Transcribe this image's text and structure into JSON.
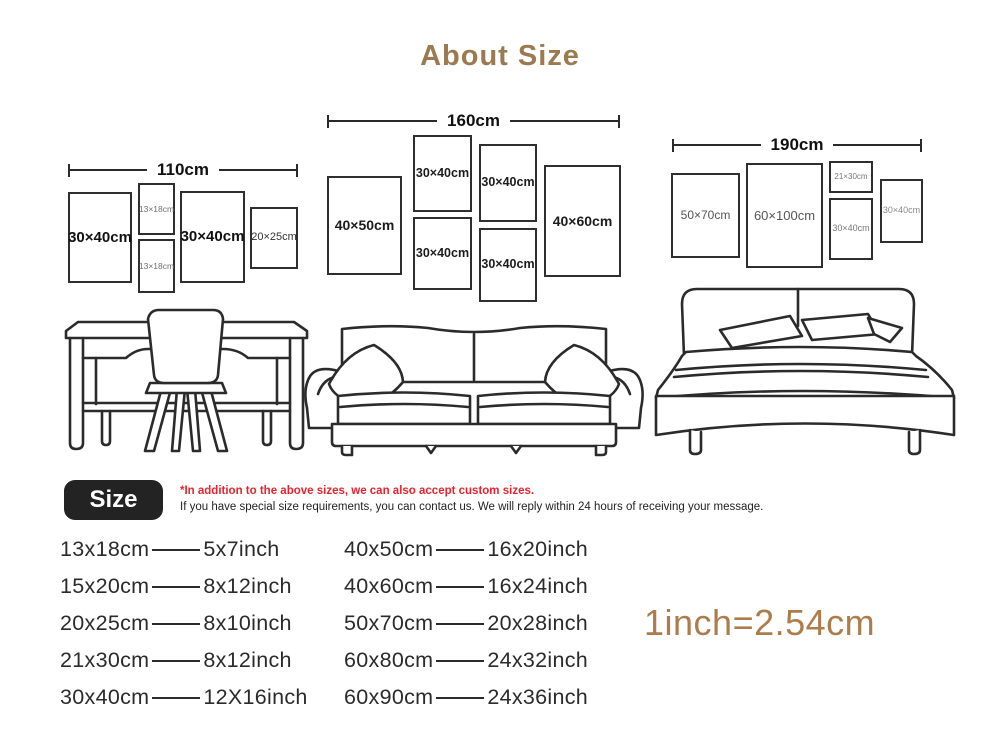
{
  "page": {
    "title": "About Size"
  },
  "colors": {
    "title_brown": "#9b7a50",
    "equivalence_brown": "#ad7c4a",
    "note_red": "#e8232e",
    "ink": "#2b2b2b"
  },
  "walls": [
    {
      "name": "desk wall",
      "width_label": "110cm",
      "furniture": "desk-and-chair",
      "frames": [
        {
          "label": "30×40cm"
        },
        {
          "label": "13×18cm"
        },
        {
          "label": "13×18cm"
        },
        {
          "label": "30×40cm"
        },
        {
          "label": "20×25cm"
        }
      ]
    },
    {
      "name": "sofa wall",
      "width_label": "160cm",
      "furniture": "sofa",
      "frames": [
        {
          "label": "40×50cm"
        },
        {
          "label": "30×40cm"
        },
        {
          "label": "30×40cm"
        },
        {
          "label": "30×40cm"
        },
        {
          "label": "30×40cm"
        },
        {
          "label": "40×60cm"
        }
      ]
    },
    {
      "name": "bed wall",
      "width_label": "190cm",
      "furniture": "bed",
      "frames": [
        {
          "label": "50×70cm"
        },
        {
          "label": "60×100cm"
        },
        {
          "label": "21×30cm"
        },
        {
          "label": "30×40cm"
        },
        {
          "label": "30×40cm"
        }
      ]
    }
  ],
  "size_note": {
    "badge": "Size",
    "line1": "*In addition to the above sizes, we can also accept custom sizes.",
    "line2": "If you have special size requirements, you can contact us. We will reply within 24 hours of receiving your message."
  },
  "conversion": {
    "col1": [
      {
        "cm": "13x18cm",
        "inch": "5x7inch"
      },
      {
        "cm": "15x20cm",
        "inch": "8x12inch"
      },
      {
        "cm": "20x25cm",
        "inch": "8x10inch"
      },
      {
        "cm": "21x30cm",
        "inch": "8x12inch"
      },
      {
        "cm": "30x40cm",
        "inch": "12X16inch"
      }
    ],
    "col2": [
      {
        "cm": "40x50cm",
        "inch": "16x20inch"
      },
      {
        "cm": "40x60cm",
        "inch": "16x24inch"
      },
      {
        "cm": "50x70cm",
        "inch": "20x28inch"
      },
      {
        "cm": "60x80cm",
        "inch": "24x32inch"
      },
      {
        "cm": "60x90cm",
        "inch": "24x36inch"
      }
    ],
    "equivalence": "1inch=2.54cm"
  }
}
